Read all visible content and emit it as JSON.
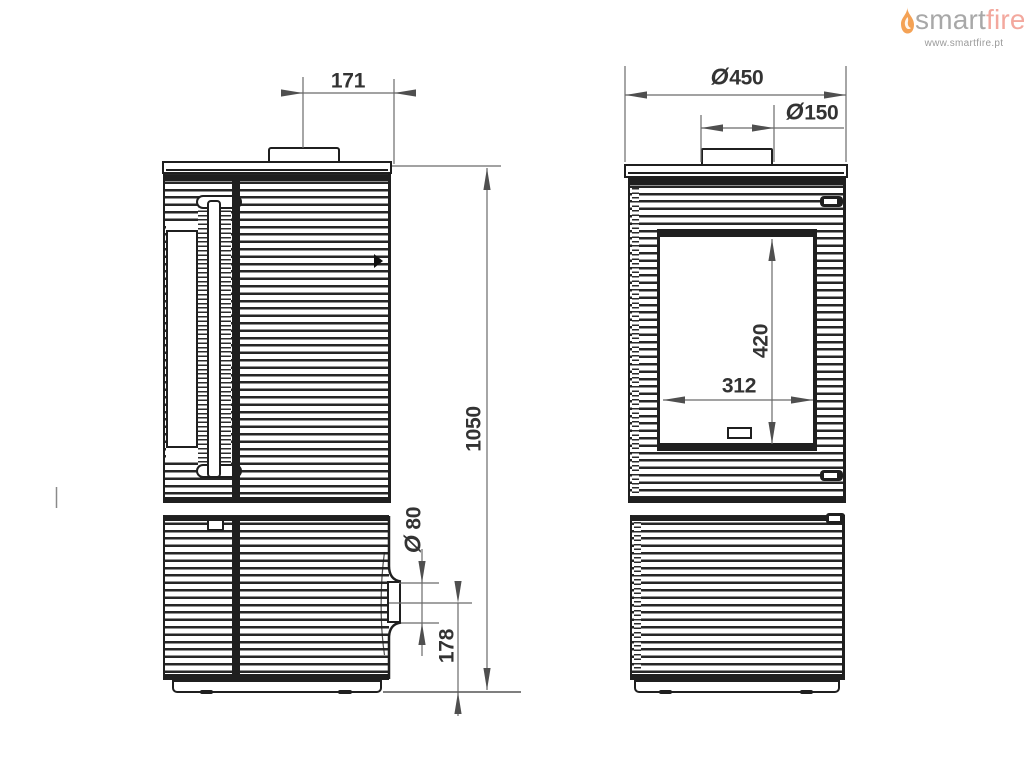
{
  "logo": {
    "brand_first": "smart",
    "brand_second": "fire",
    "website": "www.smartfire.pt",
    "colors": {
      "flame": "#f4a255",
      "brand_first": "#a8a8a8",
      "brand_second": "#f3a89e"
    }
  },
  "drawing": {
    "description": "Two-view technical drawing of a cylindrical wood stove (side view left, front view right)",
    "diameter_symbol": "Ø",
    "colors": {
      "line": "#1f1f1f",
      "dimension": "#6a6a6a",
      "text": "#333333"
    },
    "side_view": {
      "dims": {
        "flue_center_offset": "171",
        "overall_height": "1050",
        "air_inlet_diameter_value": "80",
        "air_inlet_axis_height": "178"
      }
    },
    "front_view": {
      "dims": {
        "overall_diameter_value": "450",
        "flue_diameter_value": "150",
        "glass_height": "420",
        "glass_width": "312"
      }
    }
  }
}
